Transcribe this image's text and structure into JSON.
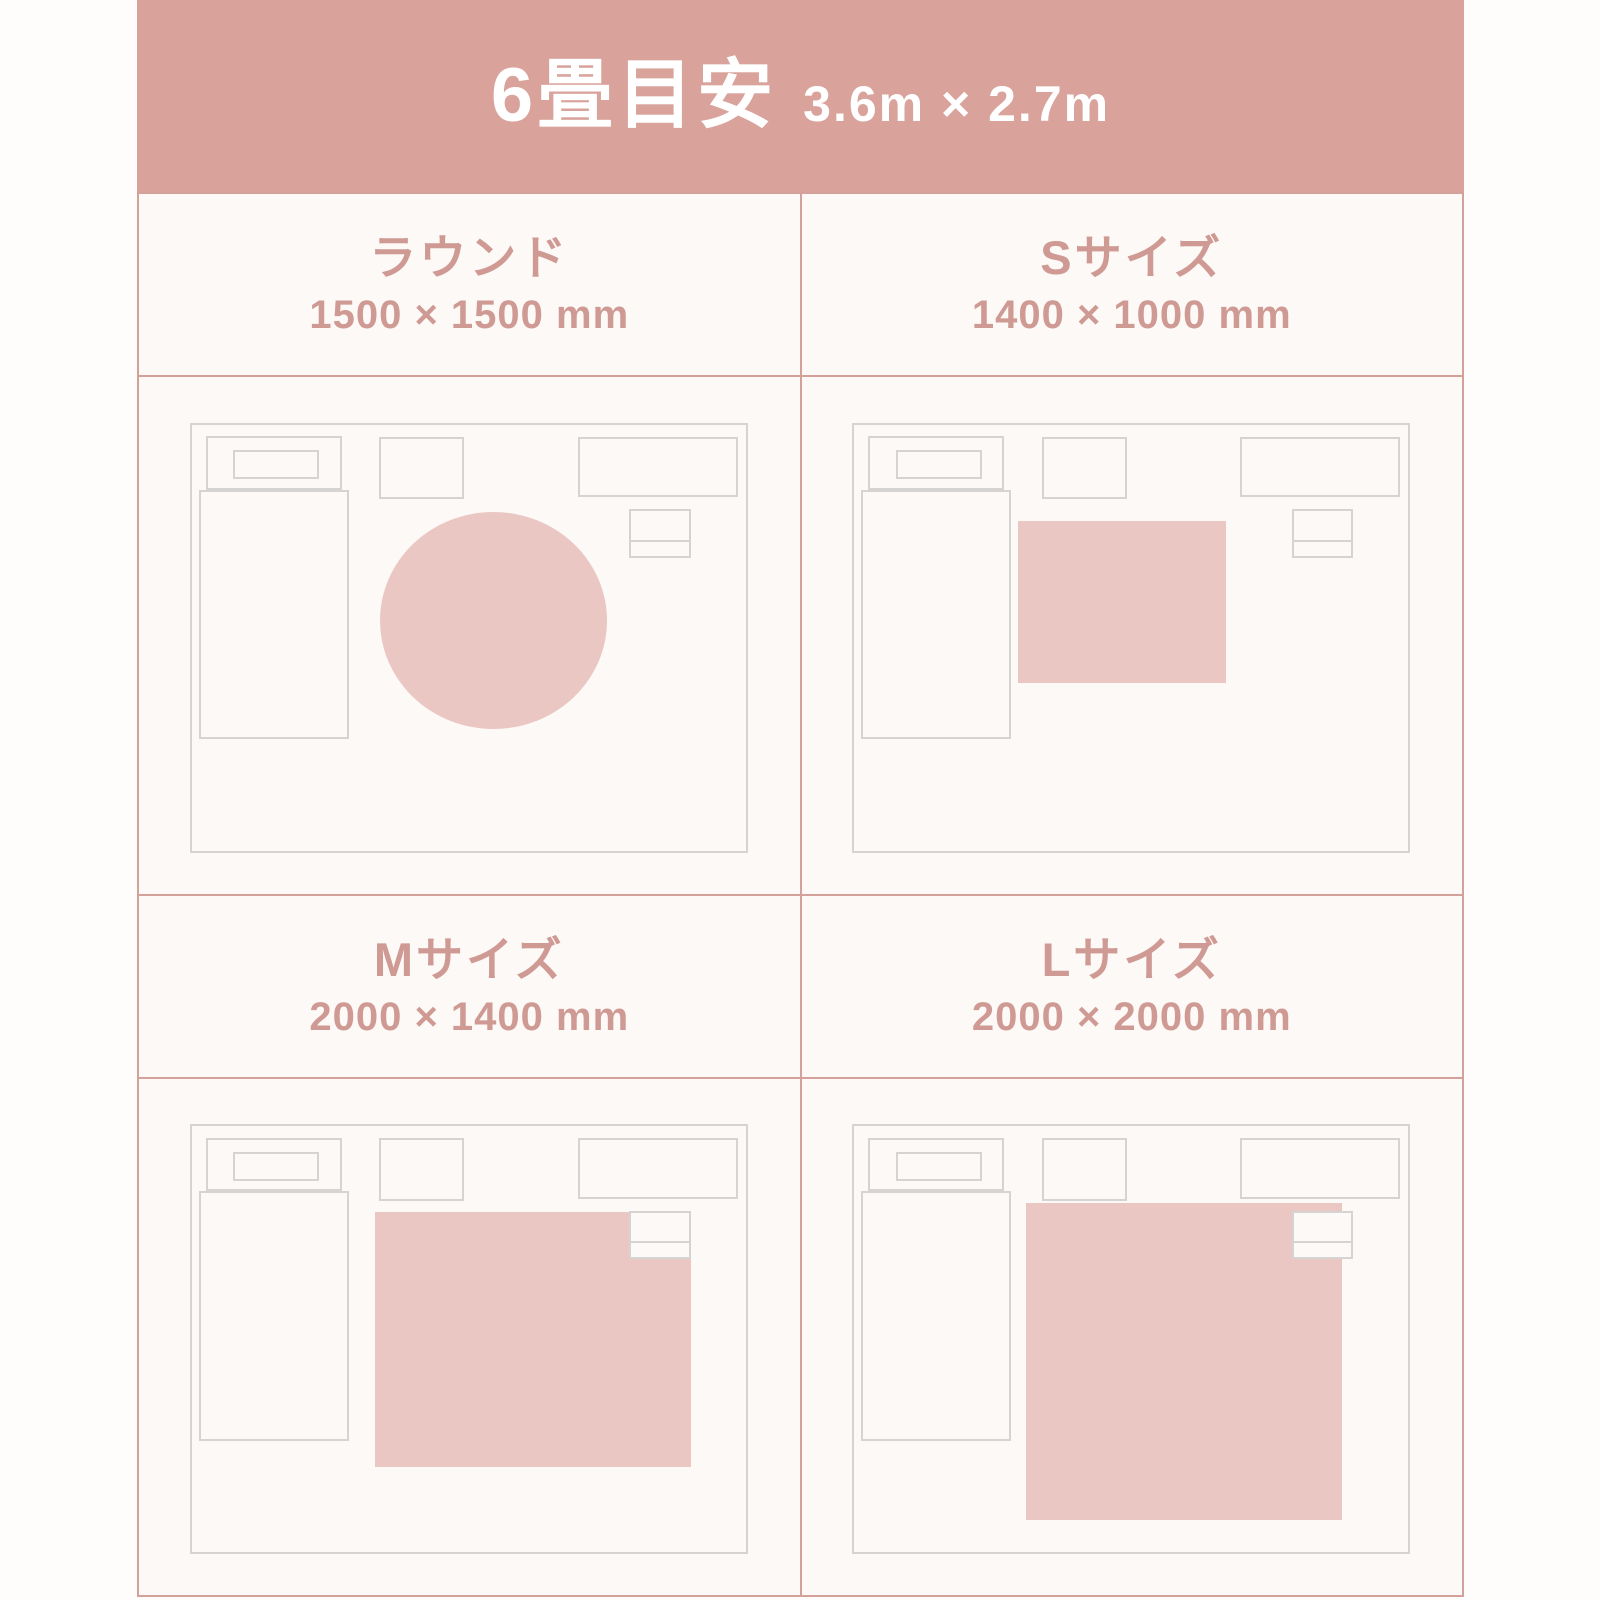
{
  "header": {
    "title": "6畳目安",
    "subtitle": "3.6m × 2.7m"
  },
  "cards": [
    {
      "label": "ラウンド",
      "dimensions": "1500 × 1500 mm",
      "rug": {
        "shape": "round",
        "left": "34%",
        "top": "20.5%",
        "width": "41%",
        "height": "51%"
      }
    },
    {
      "label": "Sサイズ",
      "dimensions": "1400 × 1000 mm",
      "rug": {
        "shape": "rect",
        "left": "29.5%",
        "top": "22.5%",
        "width": "37.5%",
        "height": "38%"
      }
    },
    {
      "label": "Mサイズ",
      "dimensions": "2000 × 1400 mm",
      "rug": {
        "shape": "rect",
        "left": "33%",
        "top": "20%",
        "width": "57%",
        "height": "60%"
      }
    },
    {
      "label": "Lサイズ",
      "dimensions": "2000 × 2000 mm",
      "rug": {
        "shape": "rect",
        "left": "31%",
        "top": "18%",
        "width": "57%",
        "height": "74.5%"
      }
    }
  ],
  "colors": {
    "banner_bg": "#d9a39c",
    "grid_border": "#d4a09a",
    "text_pink": "#cf9a93",
    "rug_fill": "#ebc7c3",
    "furniture_outline": "#d6d4d2",
    "card_bg": "#fdf9f7",
    "page_bg": "#fffdfb",
    "banner_text": "#ffffff"
  }
}
